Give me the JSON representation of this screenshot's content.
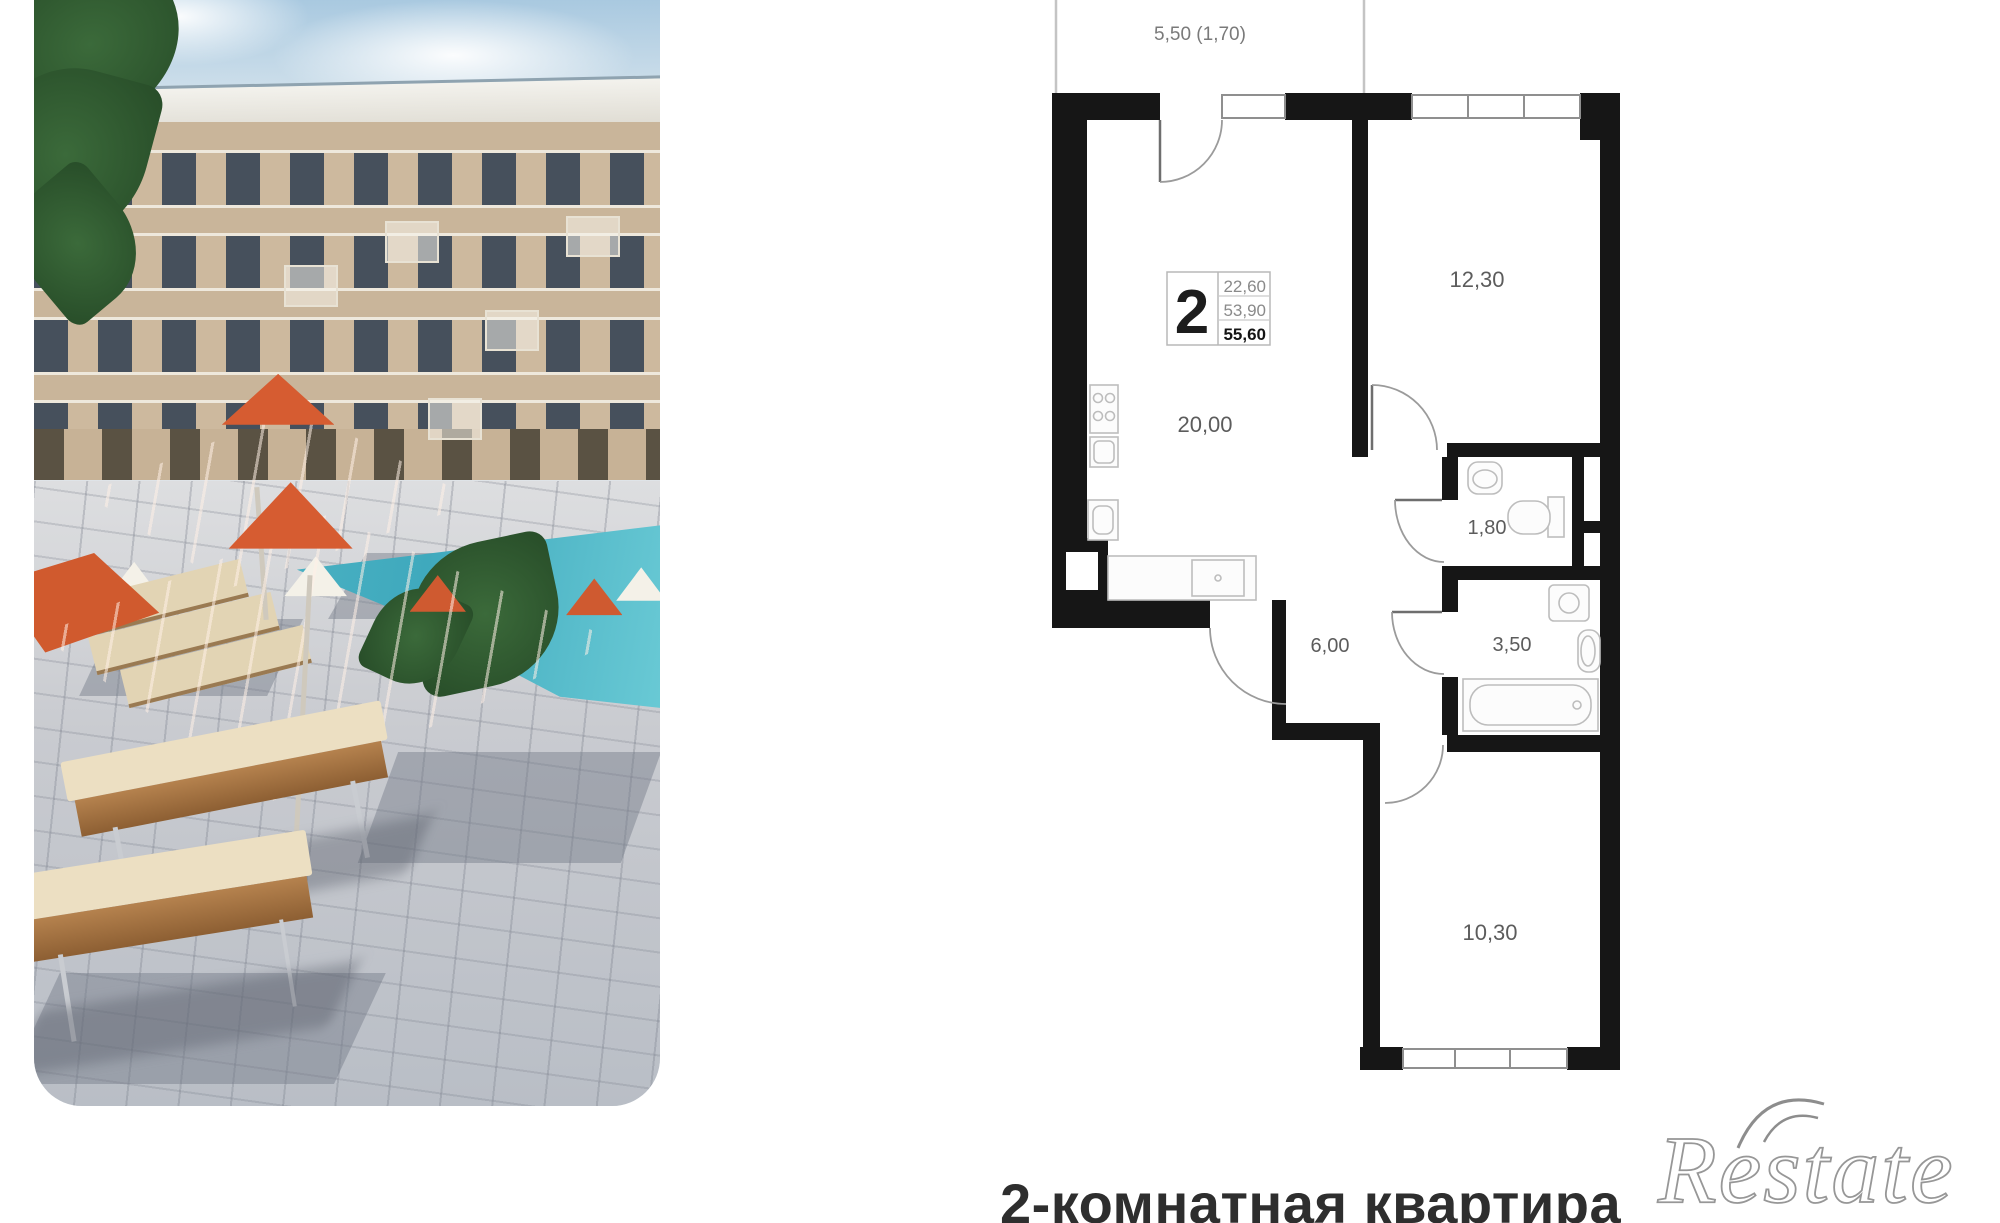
{
  "photo": {
    "alt": "Pool courtyard with orange umbrellas, sun loungers and apartment building"
  },
  "floorplan": {
    "info": {
      "rooms": "2",
      "living_area": "22,60",
      "area_without_summer": "53,90",
      "total_area": "55,60"
    },
    "labels": {
      "balcony": "5,50 (1,70)",
      "living_kitchen": "20,00",
      "bedroom": "12,30",
      "wc": "1,80",
      "hallway": "6,00",
      "bathroom": "3,50",
      "room": "10,30"
    }
  },
  "caption": {
    "title": "2-комнатная квартира"
  },
  "watermark": {
    "brand": "Restate"
  }
}
